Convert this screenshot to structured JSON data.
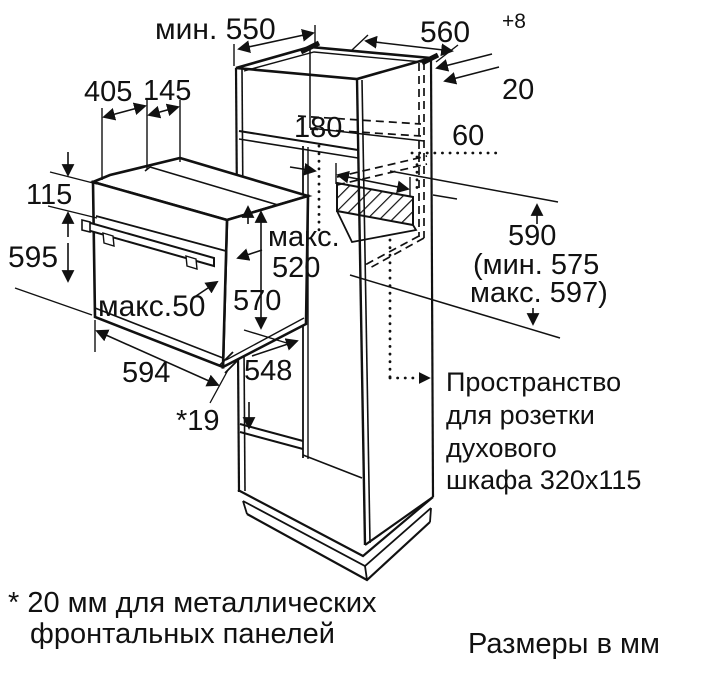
{
  "diagram": {
    "kind": "built-in oven installation drawing",
    "units_note": "Размеры в мм",
    "footnote": {
      "line1": "* 20 мм для металлических",
      "line2": "фронтальных панелей"
    },
    "socket_note": {
      "line1": "Пространство",
      "line2": "для розетки",
      "line3": "духового",
      "line4": "шкафа 320x115"
    },
    "dimensions": {
      "top_depth": "мин. 550",
      "niche_width": "560",
      "niche_width_tolerance": "+8",
      "wall_gap": "20",
      "oven_top_front": "405",
      "oven_top_rear": "145",
      "shelf_gap": "180",
      "socket_offset": "60",
      "panel_height": "115",
      "oven_height": "595",
      "max_depth_label": "макс.",
      "max_depth_value": "520",
      "inner_height": "570",
      "door_max_protrusion": "макс.50",
      "oven_width": "594",
      "oven_depth": "548",
      "front_offset": "*19",
      "niche_height": "590",
      "niche_height_min": "(мин. 575",
      "niche_height_max": "макс. 597)"
    },
    "colors": {
      "line": "#111111",
      "background": "#ffffff"
    }
  }
}
